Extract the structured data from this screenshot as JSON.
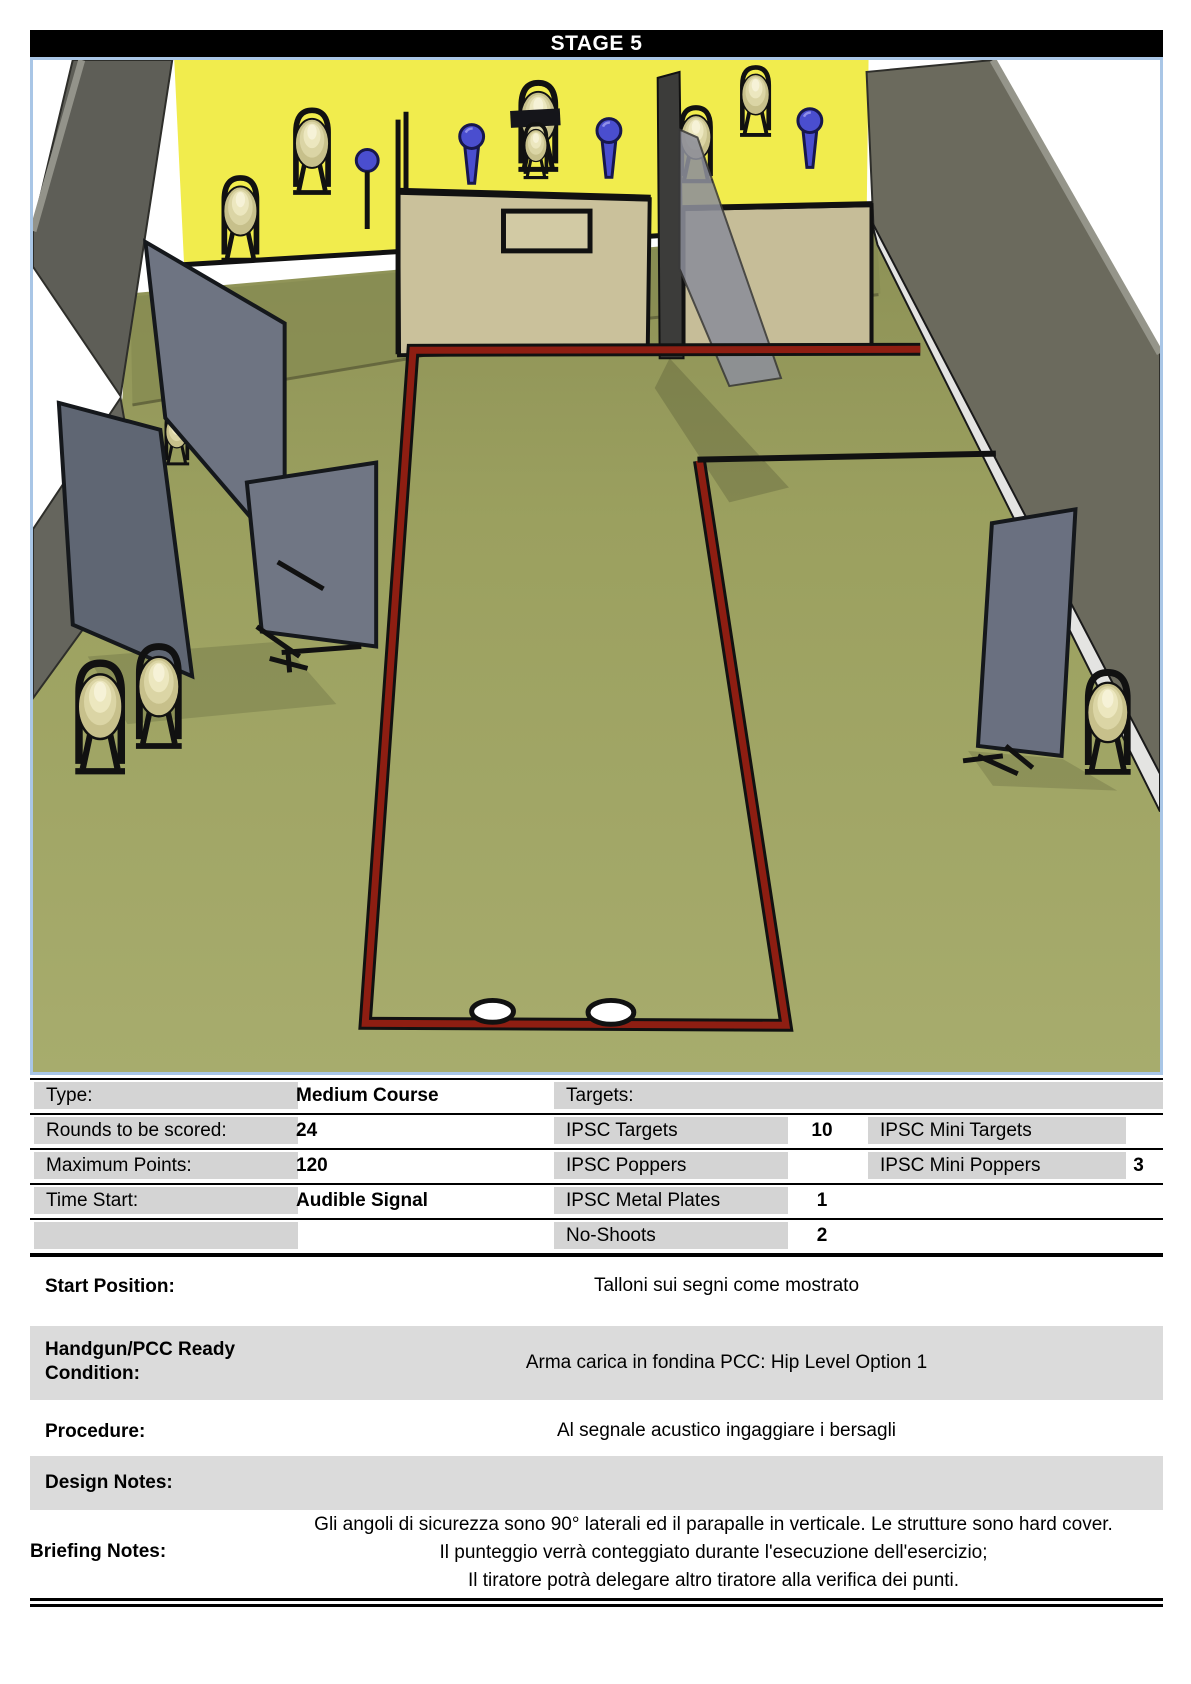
{
  "header": {
    "title": "STAGE 5"
  },
  "scene": {
    "colors": {
      "backstop_yellow": "#f1ec4d",
      "floor_olive": "#9ba05f",
      "fault_line_red": "#8e1e12",
      "barrier_gray": "#6e7482",
      "wall_tan": "#cac19b",
      "side_wall_gray": "#5e5e57",
      "popper_blue": "#4a4ecf",
      "target_tan": "#dbd5a5",
      "frame_border_blue": "#a9c6e6"
    }
  },
  "info_table": {
    "rows_left": [
      {
        "label": "Type:",
        "value": "Medium Course"
      },
      {
        "label": "Rounds to be scored:",
        "value": "24"
      },
      {
        "label": "Maximum Points:",
        "value": "120"
      },
      {
        "label": "Time Start:",
        "value": "Audible Signal"
      },
      {
        "label": "",
        "value": ""
      }
    ],
    "targets_header": "Targets:",
    "targets_col1": [
      {
        "label": "IPSC Targets",
        "value": "10"
      },
      {
        "label": "IPSC Poppers",
        "value": ""
      },
      {
        "label": "IPSC Metal Plates",
        "value": "1"
      },
      {
        "label": "No-Shoots",
        "value": "2"
      }
    ],
    "targets_col2": [
      {
        "label": "IPSC Mini Targets",
        "value": ""
      },
      {
        "label": "IPSC Mini Poppers",
        "value": "3"
      }
    ]
  },
  "sections": [
    {
      "label": "Start Position:",
      "value": "Talloni sui segni come mostrato"
    },
    {
      "label": "Handgun/PCC Ready Condition:",
      "value": "Arma carica in fondina PCC: Hip Level Option 1"
    },
    {
      "label": "Procedure:",
      "value": "Al segnale acustico ingaggiare i bersagli"
    },
    {
      "label": "Design Notes:",
      "value": ""
    },
    {
      "label": "Briefing Notes:",
      "lines": [
        "Gli angoli di sicurezza sono 90° laterali ed il parapalle in verticale. Le strutture sono hard cover.",
        "Il punteggio verrà conteggiato durante l'esecuzione dell'esercizio;",
        "Il tiratore potrà delegare altro tiratore alla verifica dei punti."
      ]
    }
  ]
}
